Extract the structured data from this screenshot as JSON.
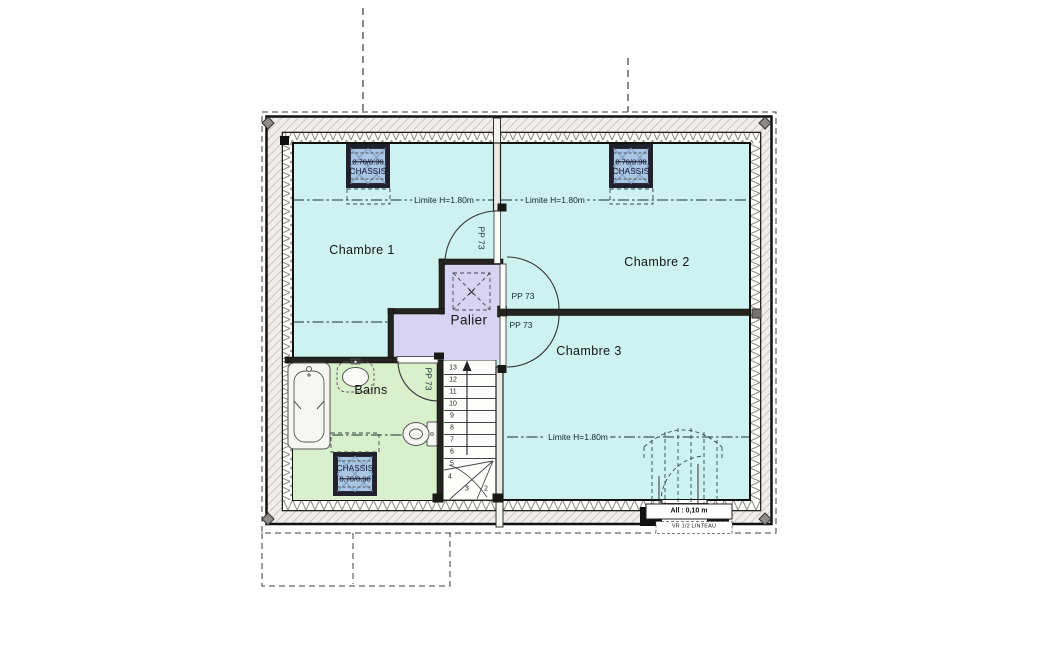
{
  "colors": {
    "room": "#cdf2f0",
    "palier": "#d9d3f3",
    "bains": "#d9f0cd",
    "window": "#a9c6e3",
    "wall_dark": "#25231f",
    "hatch_bg": "#f0edea",
    "hatch_line": "#bcb4b0",
    "line": "#1c1c1c"
  },
  "rooms": {
    "chambre1": "Chambre 1",
    "chambre2": "Chambre 2",
    "chambre3": "Chambre 3",
    "palier": "Palier",
    "bains": "Bains"
  },
  "labels": {
    "limite": "Limite H=1.80m",
    "door": "PP 73",
    "chassis": "CHASSIS",
    "chassis_dim": "0.70/0.90",
    "allege": "All : 0,10 m",
    "lintel": "VR 1/2 LINTEAU"
  },
  "stairs": {
    "numbers": [
      "13",
      "12",
      "11",
      "10",
      "9",
      "8",
      "7",
      "6",
      "5",
      "4",
      "3",
      "2"
    ]
  }
}
